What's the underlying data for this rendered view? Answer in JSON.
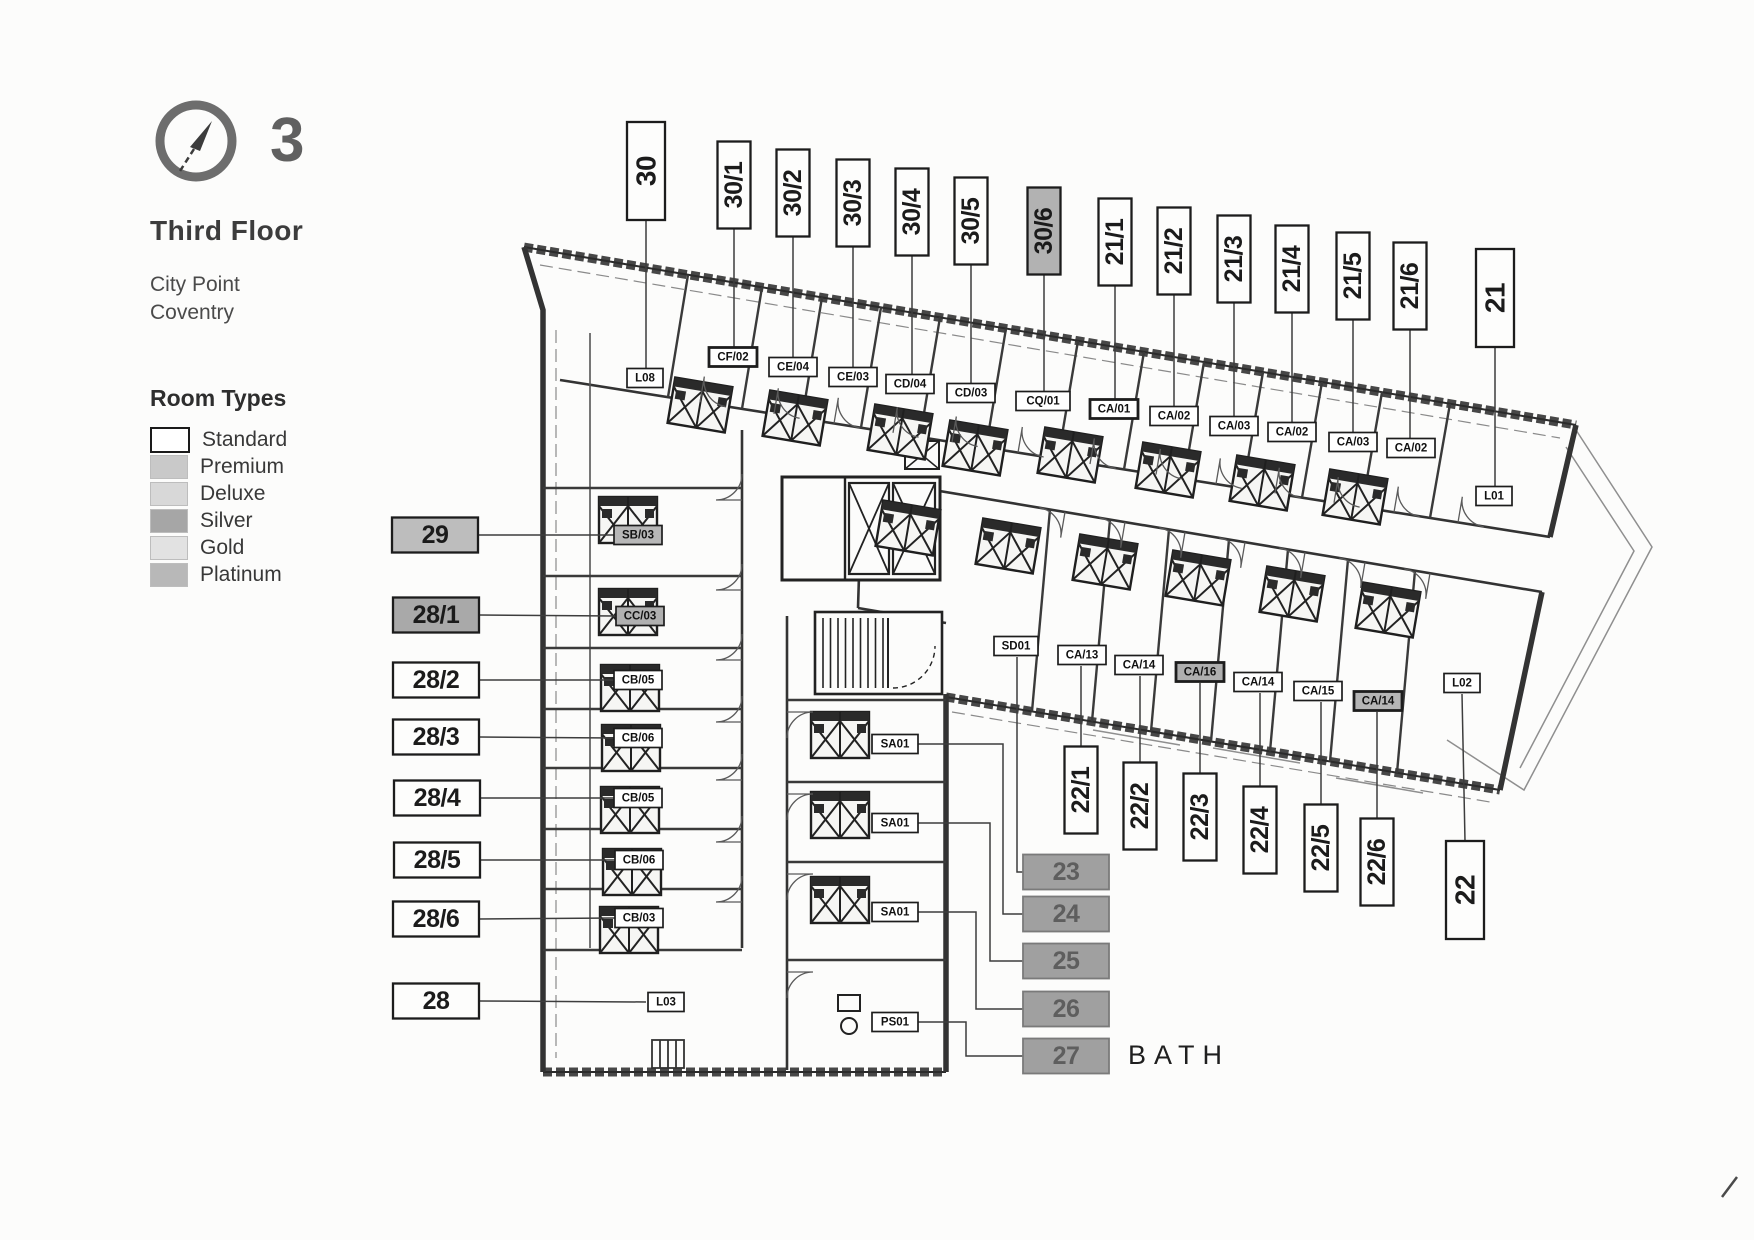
{
  "header": {
    "floor_number": "3",
    "floor_name": "Third Floor",
    "building_line1": "City Point",
    "building_line2": "Coventry"
  },
  "legend": {
    "title": "Room Types",
    "items": [
      {
        "label": "Standard",
        "fill": "#ffffff",
        "border": "#1a1a1a"
      },
      {
        "label": "Premium",
        "fill": "#c9c9c9"
      },
      {
        "label": "Deluxe",
        "fill": "#d8d8d8"
      },
      {
        "label": "Silver",
        "fill": "#a6a6a6"
      },
      {
        "label": "Gold",
        "fill": "#e2e2e2"
      },
      {
        "label": "Platinum",
        "fill": "#b8b8b8"
      }
    ]
  },
  "plan": {
    "bath_label": "BATH",
    "callouts": [
      {
        "label": "30",
        "x": 646,
        "y": 171,
        "o": "v",
        "big": 1,
        "leader": [
          [
            646,
            220
          ],
          [
            646,
            368
          ]
        ]
      },
      {
        "label": "30/1",
        "x": 734,
        "y": 185,
        "o": "v",
        "leader": [
          [
            734,
            229
          ],
          [
            734,
            347
          ]
        ]
      },
      {
        "label": "30/2",
        "x": 793,
        "y": 193,
        "o": "v",
        "leader": [
          [
            793,
            237
          ],
          [
            793,
            357
          ]
        ]
      },
      {
        "label": "30/3",
        "x": 853,
        "y": 203,
        "o": "v",
        "leader": [
          [
            853,
            247
          ],
          [
            853,
            367
          ]
        ]
      },
      {
        "label": "30/4",
        "x": 912,
        "y": 212,
        "o": "v",
        "leader": [
          [
            912,
            256
          ],
          [
            912,
            374
          ]
        ]
      },
      {
        "label": "30/5",
        "x": 971,
        "y": 221,
        "o": "v",
        "leader": [
          [
            971,
            265
          ],
          [
            971,
            383
          ]
        ]
      },
      {
        "label": "30/6",
        "x": 1044,
        "y": 231,
        "o": "v",
        "shade": "#b2b2b2",
        "leader": [
          [
            1044,
            275
          ],
          [
            1044,
            391
          ]
        ]
      },
      {
        "label": "21/1",
        "x": 1115,
        "y": 242,
        "o": "v",
        "leader": [
          [
            1115,
            286
          ],
          [
            1115,
            399
          ]
        ]
      },
      {
        "label": "21/2",
        "x": 1174,
        "y": 251,
        "o": "v",
        "leader": [
          [
            1174,
            295
          ],
          [
            1174,
            406
          ]
        ]
      },
      {
        "label": "21/3",
        "x": 1234,
        "y": 259,
        "o": "v",
        "leader": [
          [
            1234,
            303
          ],
          [
            1234,
            416
          ]
        ]
      },
      {
        "label": "21/4",
        "x": 1292,
        "y": 269,
        "o": "v",
        "leader": [
          [
            1292,
            313
          ],
          [
            1292,
            422
          ]
        ]
      },
      {
        "label": "21/5",
        "x": 1353,
        "y": 276,
        "o": "v",
        "leader": [
          [
            1353,
            320
          ],
          [
            1353,
            432
          ]
        ]
      },
      {
        "label": "21/6",
        "x": 1410,
        "y": 286,
        "o": "v",
        "leader": [
          [
            1410,
            330
          ],
          [
            1410,
            438
          ]
        ]
      },
      {
        "label": "21",
        "x": 1495,
        "y": 298,
        "o": "v",
        "big": 1,
        "leader": [
          [
            1495,
            347
          ],
          [
            1495,
            486
          ]
        ]
      },
      {
        "label": "29",
        "x": 435,
        "y": 535,
        "shade": "#bdbdbd",
        "leader": [
          [
            478,
            535
          ],
          [
            614,
            535
          ]
        ]
      },
      {
        "label": "28/1",
        "x": 436,
        "y": 615,
        "shade": "#a9a9a9",
        "leader": [
          [
            479,
            615
          ],
          [
            616,
            616
          ]
        ]
      },
      {
        "label": "28/2",
        "x": 436,
        "y": 680,
        "leader": [
          [
            479,
            680
          ],
          [
            614,
            680
          ]
        ]
      },
      {
        "label": "28/3",
        "x": 436,
        "y": 737,
        "leader": [
          [
            479,
            737
          ],
          [
            614,
            738
          ]
        ]
      },
      {
        "label": "28/4",
        "x": 437,
        "y": 798,
        "leader": [
          [
            480,
            798
          ],
          [
            614,
            798
          ]
        ]
      },
      {
        "label": "28/5",
        "x": 437,
        "y": 860,
        "leader": [
          [
            480,
            860
          ],
          [
            615,
            860
          ]
        ]
      },
      {
        "label": "28/6",
        "x": 436,
        "y": 919,
        "leader": [
          [
            479,
            919
          ],
          [
            615,
            918
          ]
        ]
      },
      {
        "label": "28",
        "x": 436,
        "y": 1001,
        "leader": [
          [
            479,
            1001
          ],
          [
            646,
            1002
          ]
        ]
      },
      {
        "label": "22/1",
        "x": 1081,
        "y": 790,
        "o": "v",
        "leader": [
          [
            1081,
            746
          ],
          [
            1081,
            666
          ]
        ]
      },
      {
        "label": "22/2",
        "x": 1140,
        "y": 806,
        "o": "v",
        "leader": [
          [
            1140,
            762
          ],
          [
            1140,
            676
          ]
        ]
      },
      {
        "label": "22/3",
        "x": 1200,
        "y": 817,
        "o": "v",
        "leader": [
          [
            1200,
            773
          ],
          [
            1200,
            683
          ]
        ]
      },
      {
        "label": "22/4",
        "x": 1260,
        "y": 830,
        "o": "v",
        "leader": [
          [
            1260,
            786
          ],
          [
            1260,
            693
          ]
        ]
      },
      {
        "label": "22/5",
        "x": 1321,
        "y": 848,
        "o": "v",
        "leader": [
          [
            1321,
            804
          ],
          [
            1321,
            702
          ]
        ]
      },
      {
        "label": "22/6",
        "x": 1377,
        "y": 862,
        "o": "v",
        "leader": [
          [
            1377,
            818
          ],
          [
            1377,
            712
          ]
        ]
      },
      {
        "label": "22",
        "x": 1465,
        "y": 890,
        "o": "v",
        "big": 1,
        "leader": [
          [
            1465,
            841
          ],
          [
            1462,
            694
          ]
        ]
      },
      {
        "label": "23",
        "x": 1066,
        "y": 872,
        "shade": "#a0a0a0",
        "soft": 1,
        "leader": [
          [
            1023,
            872
          ],
          [
            1017,
            872
          ],
          [
            1017,
            657
          ]
        ]
      },
      {
        "label": "24",
        "x": 1066,
        "y": 914,
        "shade": "#a0a0a0",
        "soft": 1,
        "leader": [
          [
            1023,
            914
          ],
          [
            1003,
            914
          ],
          [
            1003,
            744
          ],
          [
            918,
            744
          ]
        ]
      },
      {
        "label": "25",
        "x": 1066,
        "y": 961,
        "shade": "#a0a0a0",
        "soft": 1,
        "leader": [
          [
            1023,
            961
          ],
          [
            990,
            961
          ],
          [
            990,
            823
          ],
          [
            918,
            823
          ]
        ]
      },
      {
        "label": "26",
        "x": 1066,
        "y": 1009,
        "shade": "#a0a0a0",
        "soft": 1,
        "leader": [
          [
            1023,
            1009
          ],
          [
            976,
            1009
          ],
          [
            976,
            912
          ],
          [
            918,
            912
          ]
        ]
      },
      {
        "label": "27",
        "x": 1066,
        "y": 1056,
        "shade": "#a0a0a0",
        "soft": 1,
        "leader": [
          [
            1023,
            1056
          ],
          [
            966,
            1056
          ],
          [
            966,
            1022
          ],
          [
            918,
            1022
          ]
        ]
      }
    ],
    "room_codes": [
      {
        "label": "L08",
        "x": 645,
        "y": 378,
        "w": 36
      },
      {
        "label": "CF/02",
        "x": 733,
        "y": 357,
        "bold": 1
      },
      {
        "label": "CE/04",
        "x": 793,
        "y": 367
      },
      {
        "label": "CE/03",
        "x": 853,
        "y": 377
      },
      {
        "label": "CD/04",
        "x": 910,
        "y": 384
      },
      {
        "label": "CD/03",
        "x": 971,
        "y": 393
      },
      {
        "label": "CQ/01",
        "x": 1043,
        "y": 401,
        "w": 54
      },
      {
        "label": "CA/01",
        "x": 1114,
        "y": 409,
        "bold": 1
      },
      {
        "label": "CA/02",
        "x": 1174,
        "y": 416
      },
      {
        "label": "CA/03",
        "x": 1234,
        "y": 426
      },
      {
        "label": "CA/02",
        "x": 1292,
        "y": 432
      },
      {
        "label": "CA/03",
        "x": 1353,
        "y": 442
      },
      {
        "label": "CA/02",
        "x": 1411,
        "y": 448
      },
      {
        "label": "L01",
        "x": 1494,
        "y": 496,
        "w": 36
      },
      {
        "label": "SB/03",
        "x": 638,
        "y": 535,
        "shade": "#b7b7b7"
      },
      {
        "label": "CC/03",
        "x": 640,
        "y": 616,
        "shade": "#b0b0b0"
      },
      {
        "label": "CB/05",
        "x": 638,
        "y": 680
      },
      {
        "label": "CB/06",
        "x": 638,
        "y": 738
      },
      {
        "label": "CB/05",
        "x": 638,
        "y": 798
      },
      {
        "label": "CB/06",
        "x": 639,
        "y": 860
      },
      {
        "label": "CB/03",
        "x": 639,
        "y": 918
      },
      {
        "label": "L03",
        "x": 666,
        "y": 1002,
        "w": 36
      },
      {
        "label": "SD01",
        "x": 1016,
        "y": 646,
        "w": 44
      },
      {
        "label": "CA/13",
        "x": 1082,
        "y": 655
      },
      {
        "label": "CA/14",
        "x": 1139,
        "y": 665
      },
      {
        "label": "CA/16",
        "x": 1200,
        "y": 672,
        "shade": "#afafaf",
        "bold": 1
      },
      {
        "label": "CA/14",
        "x": 1258,
        "y": 682
      },
      {
        "label": "CA/15",
        "x": 1318,
        "y": 691
      },
      {
        "label": "CA/14",
        "x": 1378,
        "y": 701,
        "shade": "#b5b5b5",
        "bold": 1
      },
      {
        "label": "L02",
        "x": 1462,
        "y": 683,
        "w": 36
      },
      {
        "label": "SA01",
        "x": 895,
        "y": 744,
        "w": 46
      },
      {
        "label": "SA01",
        "x": 895,
        "y": 823,
        "w": 46
      },
      {
        "label": "SA01",
        "x": 895,
        "y": 912,
        "w": 46
      },
      {
        "label": "PS01",
        "x": 895,
        "y": 1022,
        "w": 46
      }
    ]
  }
}
